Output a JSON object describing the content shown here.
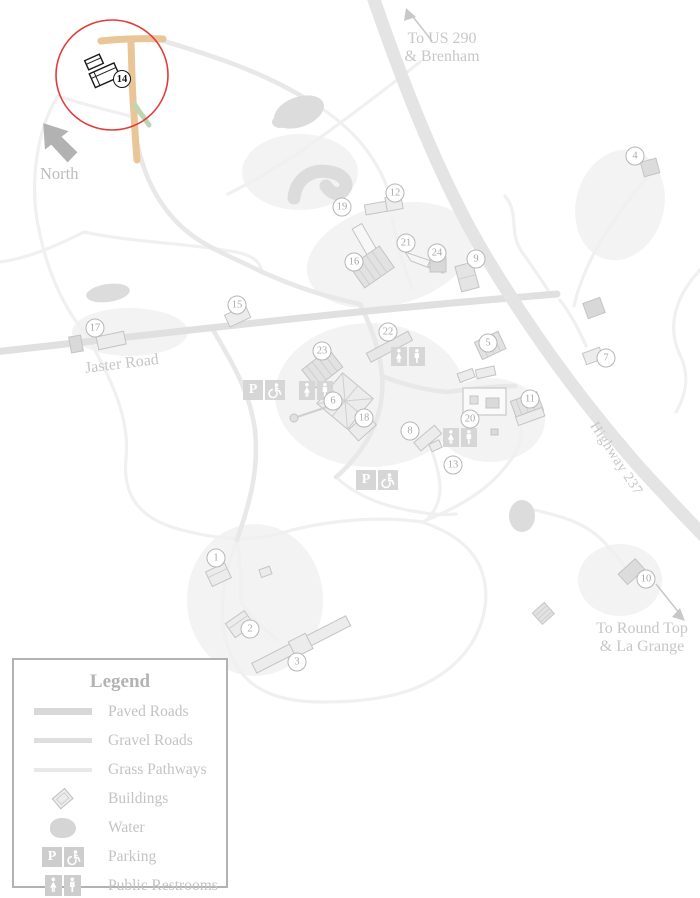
{
  "map": {
    "labels": {
      "to_us_290": "To US 290\n& Brenham",
      "north": "North",
      "jaster_road": "Jaster Road",
      "highway_237": "Highway 237",
      "to_round_top": "To Round Top\n& La Grange"
    },
    "highlight": {
      "circle_color": "#e23b3b",
      "road_color": "#e9c598",
      "path_color": "#bcd6b2",
      "building_outline": "#1a1a1a"
    },
    "markers": [
      {
        "n": "1",
        "x": 216,
        "y": 558
      },
      {
        "n": "2",
        "x": 250,
        "y": 629
      },
      {
        "n": "3",
        "x": 297,
        "y": 662
      },
      {
        "n": "4",
        "x": 635,
        "y": 156
      },
      {
        "n": "5",
        "x": 488,
        "y": 343
      },
      {
        "n": "6",
        "x": 333,
        "y": 401
      },
      {
        "n": "7",
        "x": 606,
        "y": 358
      },
      {
        "n": "8",
        "x": 410,
        "y": 431
      },
      {
        "n": "9",
        "x": 476,
        "y": 259
      },
      {
        "n": "10",
        "x": 646,
        "y": 579
      },
      {
        "n": "11",
        "x": 530,
        "y": 399
      },
      {
        "n": "12",
        "x": 395,
        "y": 193
      },
      {
        "n": "13",
        "x": 453,
        "y": 465
      },
      {
        "n": "14",
        "x": 122,
        "y": 79,
        "highlight": true
      },
      {
        "n": "15",
        "x": 237,
        "y": 305
      },
      {
        "n": "16",
        "x": 354,
        "y": 262
      },
      {
        "n": "17",
        "x": 95,
        "y": 328
      },
      {
        "n": "18",
        "x": 364,
        "y": 418
      },
      {
        "n": "19",
        "x": 342,
        "y": 207
      },
      {
        "n": "20",
        "x": 470,
        "y": 419
      },
      {
        "n": "21",
        "x": 406,
        "y": 243
      },
      {
        "n": "22",
        "x": 388,
        "y": 332
      },
      {
        "n": "23",
        "x": 322,
        "y": 351
      },
      {
        "n": "24",
        "x": 437,
        "y": 253
      }
    ]
  },
  "legend": {
    "title": "Legend",
    "parking_glyph": "P",
    "items": [
      {
        "label": "Paved Roads",
        "icon": "paved-road"
      },
      {
        "label": "Gravel Roads",
        "icon": "gravel-road"
      },
      {
        "label": "Grass Pathways",
        "icon": "grass-pathway"
      },
      {
        "label": "Buildings",
        "icon": "building"
      },
      {
        "label": "Water",
        "icon": "water"
      },
      {
        "label": "Parking",
        "icon": "parking"
      },
      {
        "label": "Public Restrooms",
        "icon": "restrooms"
      }
    ]
  }
}
